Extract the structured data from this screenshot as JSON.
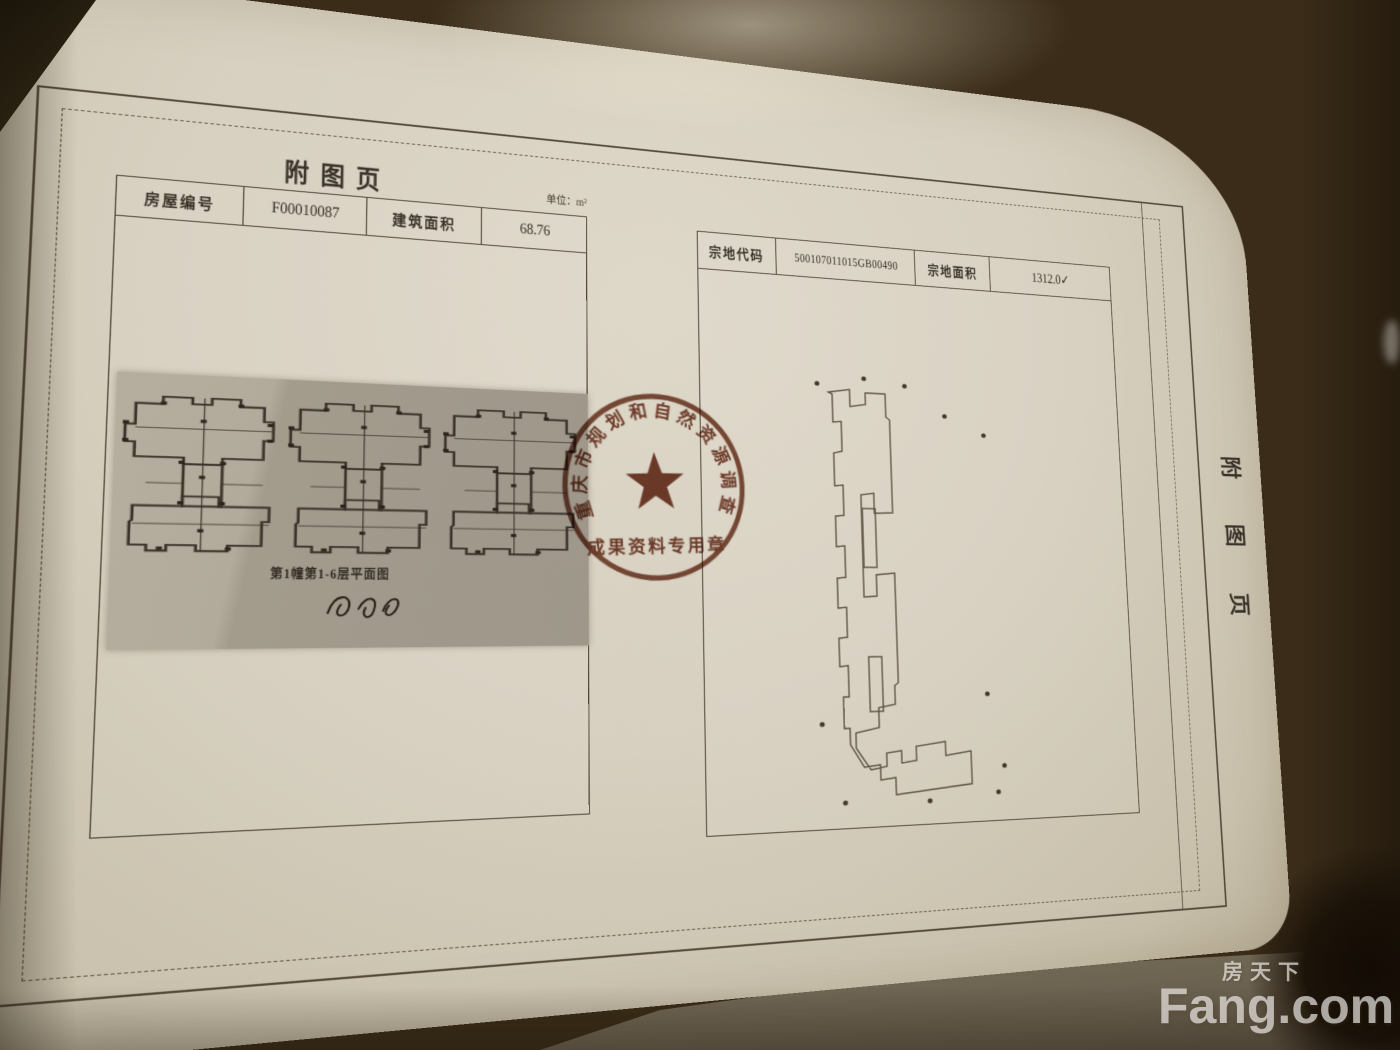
{
  "page": {
    "main_title": "附图页",
    "side_title_chars": [
      "附",
      "图",
      "页"
    ],
    "unit_note": "单位：m²",
    "house_table": {
      "id_label": "房屋编号",
      "id_value": "F00010087",
      "area_label": "建筑面积",
      "area_value": "68.76"
    },
    "parcel_table": {
      "code_label": "宗地代码",
      "code_value": "500107011015GB00490",
      "area_label": "宗地面积",
      "area_value": "1312.0✓"
    },
    "floor_plan": {
      "caption": "第1幢第1-6层平面图"
    },
    "stamp": {
      "arc_text": "重庆市规划和自然资源调查监测院",
      "bottom_text": "成果资料专用章",
      "color": "#703320"
    }
  },
  "watermark": {
    "logo": "Fang.com",
    "cn": "房天下"
  },
  "colors": {
    "paper": "#d7d0c0",
    "ink": "#332c22",
    "frame": "#55493a",
    "plan_panel": "#a89f90",
    "background_gold": "#b08944"
  }
}
